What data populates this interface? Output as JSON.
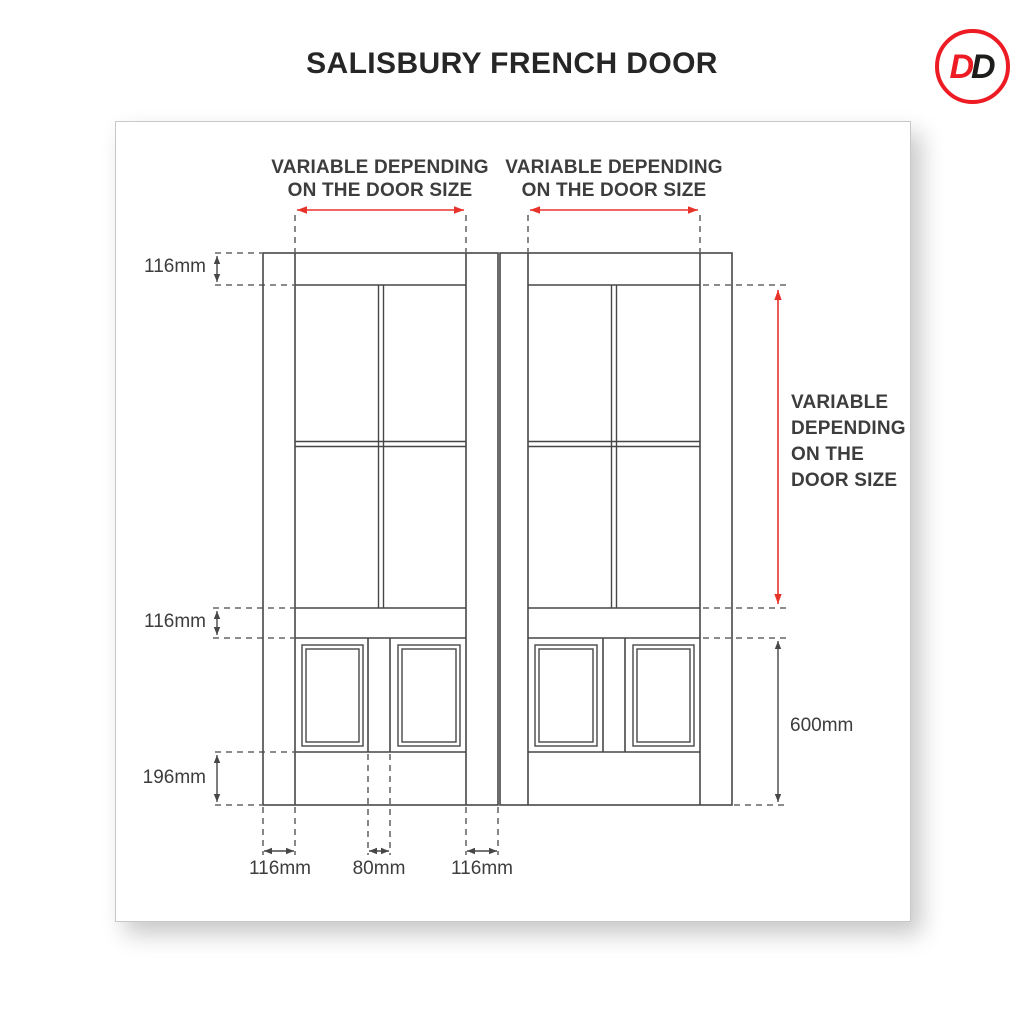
{
  "title": "SALISBURY FRENCH DOOR",
  "logo": {
    "letter1": "D",
    "letter2": "D"
  },
  "colors": {
    "red": "#e8332a",
    "line": "#474747",
    "text": "#3d3d3d",
    "title": "#262626",
    "card_border": "#c8c8c8",
    "logo_red": "#ed1c24",
    "logo_dark": "#1d1d1b"
  },
  "annotations": {
    "top_left_width": {
      "line1": "VARIABLE DEPENDING",
      "line2": "ON THE DOOR SIZE"
    },
    "top_right_width": {
      "line1": "VARIABLE DEPENDING",
      "line2": "ON THE DOOR SIZE"
    },
    "right_height": {
      "lines": [
        "VARIABLE",
        "DEPENDING",
        "ON THE",
        "DOOR SIZE"
      ]
    },
    "dim_top_rail": "116mm",
    "dim_mid_rail": "116mm",
    "dim_bottom_rail": "196mm",
    "dim_bottom_section_height": "600mm",
    "dim_left_stile": "116mm",
    "dim_center_muntin": "80mm",
    "dim_meeting_stile": "116mm"
  }
}
